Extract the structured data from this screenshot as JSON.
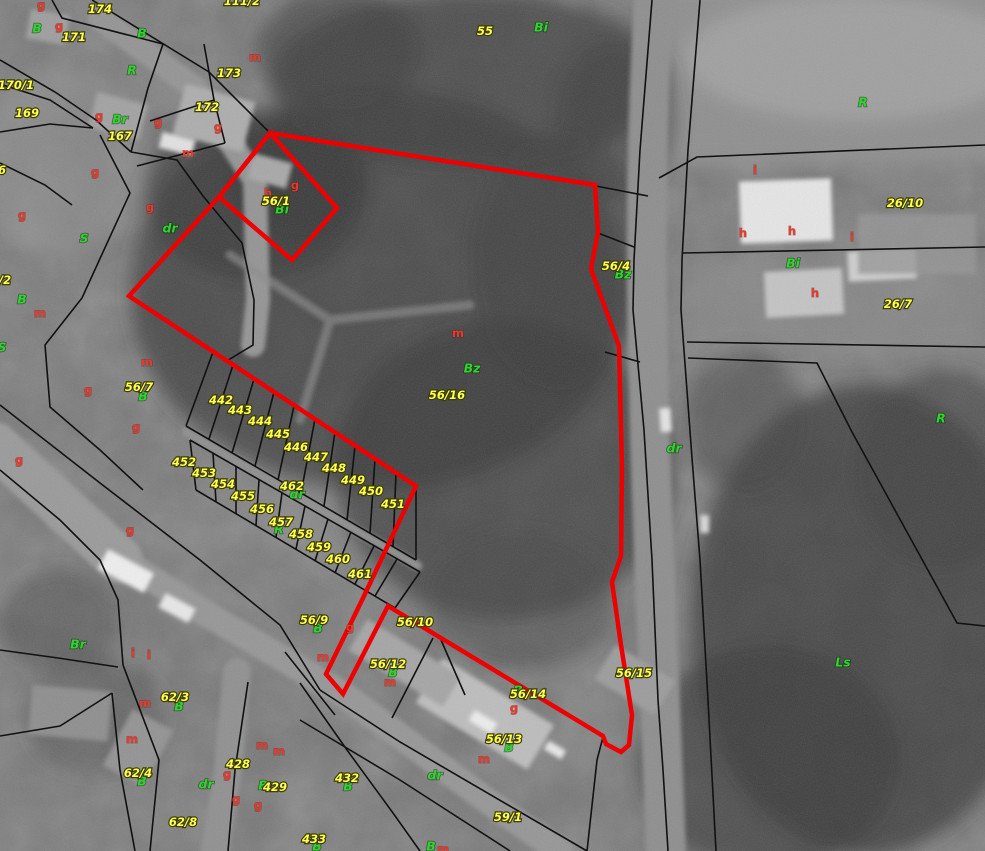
{
  "map": {
    "colors": {
      "parcel_label": "#ffff55",
      "landuse_label": "#2ed52e",
      "code_label": "#e8392b",
      "selection_outline": "#ee0000",
      "cadastral_line": "#111111"
    },
    "red_outline": {
      "stroke_width": 4.5,
      "main": [
        [
          270,
          133
        ],
        [
          595,
          185
        ],
        [
          598,
          232
        ],
        [
          591,
          269
        ],
        [
          619,
          346
        ],
        [
          622,
          468
        ],
        [
          621,
          556
        ],
        [
          612,
          582
        ],
        [
          621,
          645
        ],
        [
          632,
          715
        ],
        [
          629,
          745
        ],
        [
          621,
          752
        ],
        [
          606,
          744
        ],
        [
          603,
          736
        ],
        [
          388,
          606
        ],
        [
          343,
          694
        ],
        [
          326,
          674
        ],
        [
          364,
          596
        ],
        [
          416,
          486
        ],
        [
          182,
          331
        ],
        [
          129,
          296
        ],
        [
          219,
          197
        ]
      ],
      "annex_square": [
        [
          270,
          133
        ],
        [
          337,
          208
        ],
        [
          292,
          260
        ],
        [
          219,
          197
        ]
      ]
    },
    "black_lines": [
      [
        92,
        0,
        209,
        72,
        268,
        131
      ],
      [
        52,
        0,
        62,
        18,
        163,
        44
      ],
      [
        163,
        44,
        148,
        88,
        131,
        152
      ],
      [
        0,
        60,
        55,
        92,
        96,
        120,
        131,
        152
      ],
      [
        204,
        44,
        214,
        100,
        225,
        143
      ],
      [
        150,
        121,
        214,
        100
      ],
      [
        137,
        166,
        225,
        143
      ],
      [
        0,
        84,
        50,
        100,
        93,
        128
      ],
      [
        0,
        132,
        50,
        124,
        93,
        128
      ],
      [
        131,
        152,
        177,
        160,
        203,
        196,
        242,
        243,
        254,
        300,
        253,
        345,
        225,
        362
      ],
      [
        100,
        135,
        130,
        193,
        82,
        298,
        45,
        345,
        50,
        407,
        100,
        450,
        143,
        490
      ],
      [
        0,
        163,
        45,
        185,
        72,
        205
      ],
      [
        652,
        0,
        640,
        150,
        634,
        260,
        633,
        310,
        644,
        430,
        652,
        560,
        658,
        700,
        663,
        770,
        668,
        851
      ],
      [
        700,
        0,
        688,
        150,
        682,
        260,
        681,
        310,
        692,
        458,
        700,
        560,
        708,
        700,
        716,
        851
      ],
      [
        598,
        233,
        634,
        247
      ],
      [
        605,
        352,
        640,
        362
      ],
      [
        596,
        186,
        648,
        196
      ],
      [
        659,
        178,
        697,
        157,
        985,
        145
      ],
      [
        683,
        253,
        985,
        247
      ],
      [
        687,
        342,
        985,
        347
      ],
      [
        688,
        358,
        817,
        363,
        852,
        432,
        957,
        623,
        985,
        626
      ],
      [
        603,
        737,
        597,
        760,
        587,
        851
      ],
      [
        320,
        690,
        400,
        742,
        587,
        851
      ],
      [
        300,
        720,
        400,
        780,
        510,
        851
      ],
      [
        433,
        638,
        392,
        718
      ],
      [
        441,
        640,
        465,
        695
      ],
      [
        0,
        405,
        100,
        483,
        200,
        560,
        280,
        625,
        320,
        690
      ],
      [
        0,
        470,
        60,
        520,
        100,
        560,
        118,
        600,
        123,
        665
      ],
      [
        123,
        665,
        159,
        760,
        150,
        851
      ],
      [
        248,
        682,
        235,
        770,
        228,
        851
      ],
      [
        0,
        650,
        58,
        658,
        118,
        667
      ],
      [
        112,
        693,
        120,
        770,
        135,
        851
      ],
      [
        0,
        736,
        60,
        726,
        112,
        693
      ],
      [
        300,
        683,
        347,
        750,
        393,
        813,
        420,
        851
      ],
      [
        285,
        652,
        335,
        715
      ],
      [
        196,
        490,
        395,
        608
      ],
      [
        186,
        426,
        416,
        560
      ],
      [
        190,
        440,
        420,
        572
      ],
      [
        213,
        352,
        416,
        486
      ],
      [
        213,
        352,
        186,
        426
      ],
      [
        233,
        365,
        209,
        439
      ],
      [
        254,
        379,
        232,
        453
      ],
      [
        274,
        392,
        255,
        466
      ],
      [
        294,
        406,
        278,
        480
      ],
      [
        315,
        419,
        301,
        493
      ],
      [
        335,
        432,
        324,
        506
      ],
      [
        355,
        446,
        347,
        520
      ],
      [
        375,
        459,
        370,
        533
      ],
      [
        396,
        473,
        393,
        547
      ],
      [
        416,
        486,
        416,
        560
      ],
      [
        190,
        440,
        196,
        490
      ],
      [
        213,
        453,
        216,
        502
      ],
      [
        236,
        466,
        236,
        514
      ],
      [
        259,
        480,
        256,
        525
      ],
      [
        282,
        493,
        276,
        537
      ],
      [
        305,
        506,
        296,
        549
      ],
      [
        328,
        519,
        315,
        561
      ],
      [
        351,
        532,
        335,
        573
      ],
      [
        374,
        546,
        355,
        584
      ],
      [
        397,
        559,
        375,
        596
      ],
      [
        420,
        572,
        395,
        608
      ]
    ],
    "parcel_labels": [
      {
        "t": "174",
        "x": 100,
        "y": 9
      },
      {
        "t": "111/2",
        "x": 242,
        "y": 1
      },
      {
        "t": "171",
        "x": 74,
        "y": 37
      },
      {
        "t": "173",
        "x": 229,
        "y": 73
      },
      {
        "t": "172",
        "x": 207,
        "y": 107
      },
      {
        "t": "170/1",
        "x": 16,
        "y": 85
      },
      {
        "t": "169",
        "x": 27,
        "y": 113
      },
      {
        "t": "167",
        "x": 120,
        "y": 136
      },
      {
        "t": "6",
        "x": 2,
        "y": 170
      },
      {
        "t": "/2",
        "x": 5,
        "y": 280
      },
      {
        "t": "55",
        "x": 485,
        "y": 31
      },
      {
        "t": "56/1",
        "x": 276,
        "y": 201
      },
      {
        "t": "56/4",
        "x": 616,
        "y": 266
      },
      {
        "t": "56/16",
        "x": 447,
        "y": 395
      },
      {
        "t": "56/7",
        "x": 139,
        "y": 387
      },
      {
        "t": "442",
        "x": 221,
        "y": 400
      },
      {
        "t": "443",
        "x": 240,
        "y": 410
      },
      {
        "t": "444",
        "x": 260,
        "y": 421
      },
      {
        "t": "445",
        "x": 278,
        "y": 434
      },
      {
        "t": "446",
        "x": 296,
        "y": 447
      },
      {
        "t": "447",
        "x": 316,
        "y": 457
      },
      {
        "t": "448",
        "x": 334,
        "y": 468
      },
      {
        "t": "449",
        "x": 353,
        "y": 480
      },
      {
        "t": "450",
        "x": 371,
        "y": 491
      },
      {
        "t": "451",
        "x": 393,
        "y": 504
      },
      {
        "t": "452",
        "x": 184,
        "y": 462
      },
      {
        "t": "453",
        "x": 204,
        "y": 473
      },
      {
        "t": "454",
        "x": 223,
        "y": 484
      },
      {
        "t": "455",
        "x": 243,
        "y": 496
      },
      {
        "t": "456",
        "x": 262,
        "y": 509
      },
      {
        "t": "457",
        "x": 281,
        "y": 522
      },
      {
        "t": "458",
        "x": 301,
        "y": 534
      },
      {
        "t": "459",
        "x": 319,
        "y": 547
      },
      {
        "t": "460",
        "x": 338,
        "y": 559
      },
      {
        "t": "461",
        "x": 360,
        "y": 574
      },
      {
        "t": "462",
        "x": 292,
        "y": 486
      },
      {
        "t": "56/9",
        "x": 314,
        "y": 620
      },
      {
        "t": "56/10",
        "x": 415,
        "y": 622
      },
      {
        "t": "56/12",
        "x": 388,
        "y": 664
      },
      {
        "t": "56/14",
        "x": 528,
        "y": 694
      },
      {
        "t": "56/13",
        "x": 504,
        "y": 739
      },
      {
        "t": "56/15",
        "x": 634,
        "y": 673
      },
      {
        "t": "26/10",
        "x": 905,
        "y": 203
      },
      {
        "t": "26/7",
        "x": 898,
        "y": 304
      },
      {
        "t": "59/1",
        "x": 508,
        "y": 817
      },
      {
        "t": "62/3",
        "x": 175,
        "y": 697
      },
      {
        "t": "62/4",
        "x": 138,
        "y": 773
      },
      {
        "t": "62/8",
        "x": 183,
        "y": 822
      },
      {
        "t": "428",
        "x": 238,
        "y": 764
      },
      {
        "t": "429",
        "x": 275,
        "y": 787
      },
      {
        "t": "432",
        "x": 347,
        "y": 778
      },
      {
        "t": "433",
        "x": 314,
        "y": 839
      }
    ],
    "landuse_labels": [
      {
        "t": "B",
        "x": 37,
        "y": 28
      },
      {
        "t": "B",
        "x": 142,
        "y": 33
      },
      {
        "t": "R",
        "x": 132,
        "y": 70
      },
      {
        "t": "Br",
        "x": 120,
        "y": 119
      },
      {
        "t": "Bi",
        "x": 541,
        "y": 27
      },
      {
        "t": "Bi",
        "x": 282,
        "y": 209
      },
      {
        "t": "S",
        "x": 84,
        "y": 238
      },
      {
        "t": "B",
        "x": 22,
        "y": 299
      },
      {
        "t": "S",
        "x": 2,
        "y": 347
      },
      {
        "t": "Bz",
        "x": 623,
        "y": 274
      },
      {
        "t": "Bz",
        "x": 472,
        "y": 368
      },
      {
        "t": "B",
        "x": 143,
        "y": 396
      },
      {
        "t": "dr",
        "x": 170,
        "y": 228
      },
      {
        "t": "dr",
        "x": 674,
        "y": 448
      },
      {
        "t": "R",
        "x": 863,
        "y": 102
      },
      {
        "t": "Bi",
        "x": 793,
        "y": 263
      },
      {
        "t": "R",
        "x": 941,
        "y": 418
      },
      {
        "t": "Ls",
        "x": 843,
        "y": 662
      },
      {
        "t": "R",
        "x": 279,
        "y": 529
      },
      {
        "t": "dr",
        "x": 297,
        "y": 494
      },
      {
        "t": "B",
        "x": 318,
        "y": 628
      },
      {
        "t": "B",
        "x": 393,
        "y": 672
      },
      {
        "t": "B",
        "x": 518,
        "y": 690
      },
      {
        "t": "B",
        "x": 509,
        "y": 747
      },
      {
        "t": "Br",
        "x": 78,
        "y": 644
      },
      {
        "t": "B",
        "x": 179,
        "y": 706
      },
      {
        "t": "B",
        "x": 142,
        "y": 781
      },
      {
        "t": "B",
        "x": 263,
        "y": 785
      },
      {
        "t": "B",
        "x": 348,
        "y": 786
      },
      {
        "t": "B",
        "x": 317,
        "y": 846
      },
      {
        "t": "B",
        "x": 431,
        "y": 846
      },
      {
        "t": "dr",
        "x": 206,
        "y": 784
      },
      {
        "t": "dr",
        "x": 435,
        "y": 775
      }
    ],
    "code_labels": [
      {
        "t": "g",
        "x": 41,
        "y": 5
      },
      {
        "t": "g",
        "x": 59,
        "y": 26
      },
      {
        "t": "m",
        "x": 255,
        "y": 57
      },
      {
        "t": "g",
        "x": 99,
        "y": 116
      },
      {
        "t": "g",
        "x": 158,
        "y": 122
      },
      {
        "t": "g",
        "x": 218,
        "y": 127
      },
      {
        "t": "m",
        "x": 188,
        "y": 153
      },
      {
        "t": "g",
        "x": 95,
        "y": 172
      },
      {
        "t": "g",
        "x": 150,
        "y": 207
      },
      {
        "t": "g",
        "x": 295,
        "y": 185
      },
      {
        "t": "h",
        "x": 268,
        "y": 193
      },
      {
        "t": "g",
        "x": 22,
        "y": 215
      },
      {
        "t": "m",
        "x": 40,
        "y": 313
      },
      {
        "t": "m",
        "x": 147,
        "y": 362
      },
      {
        "t": "g",
        "x": 88,
        "y": 390
      },
      {
        "t": "g",
        "x": 136,
        "y": 427
      },
      {
        "t": "g",
        "x": 19,
        "y": 460
      },
      {
        "t": "g",
        "x": 130,
        "y": 530
      },
      {
        "t": "m",
        "x": 458,
        "y": 333
      },
      {
        "t": "i",
        "x": 755,
        "y": 170
      },
      {
        "t": "h",
        "x": 743,
        "y": 233
      },
      {
        "t": "h",
        "x": 792,
        "y": 231
      },
      {
        "t": "i",
        "x": 852,
        "y": 237
      },
      {
        "t": "h",
        "x": 815,
        "y": 293
      },
      {
        "t": "i",
        "x": 133,
        "y": 653
      },
      {
        "t": "i",
        "x": 149,
        "y": 655
      },
      {
        "t": "m",
        "x": 145,
        "y": 703
      },
      {
        "t": "m",
        "x": 132,
        "y": 739
      },
      {
        "t": "g",
        "x": 227,
        "y": 774
      },
      {
        "t": "g",
        "x": 236,
        "y": 799
      },
      {
        "t": "g",
        "x": 258,
        "y": 805
      },
      {
        "t": "m",
        "x": 262,
        "y": 745
      },
      {
        "t": "m",
        "x": 279,
        "y": 751
      },
      {
        "t": "m",
        "x": 323,
        "y": 657
      },
      {
        "t": "g",
        "x": 350,
        "y": 627
      },
      {
        "t": "m",
        "x": 390,
        "y": 682
      },
      {
        "t": "g",
        "x": 514,
        "y": 708
      },
      {
        "t": "m",
        "x": 484,
        "y": 759
      },
      {
        "t": "m",
        "x": 443,
        "y": 849
      }
    ]
  }
}
